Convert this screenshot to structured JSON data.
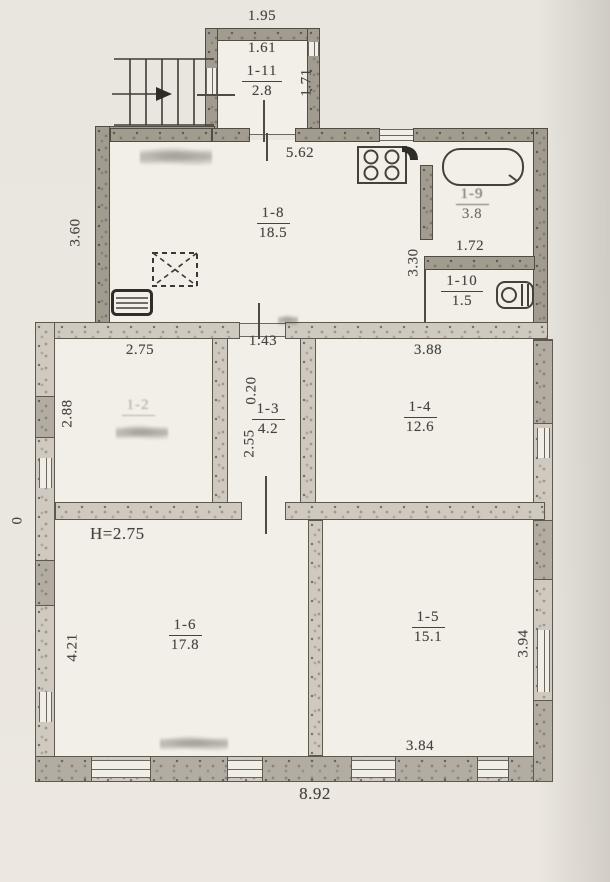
{
  "plan": {
    "height_note": "H=2.75",
    "rooms": [
      {
        "id": "1-11",
        "area": "2.8"
      },
      {
        "id": "1-8",
        "area": "18.5"
      },
      {
        "id": "1-9",
        "area": "3.8"
      },
      {
        "id": "1-10",
        "area": "1.5"
      },
      {
        "id": "1-2",
        "area": ""
      },
      {
        "id": "1-3",
        "area": "4.2"
      },
      {
        "id": "1-4",
        "area": "12.6"
      },
      {
        "id": "1-6",
        "area": "17.8"
      },
      {
        "id": "1-5",
        "area": "15.1"
      }
    ],
    "dims": {
      "d195": "1.95",
      "d161": "1.61",
      "d171": "1.71",
      "d562": "5.62",
      "d360": "3.60",
      "d330": "3.30",
      "d172": "1.72",
      "d275": "2.75",
      "d288": "2.88",
      "d143": "1.43",
      "d020": "0.20",
      "d255": "2.55",
      "d388": "3.88",
      "d0": "0",
      "d421": "4.21",
      "d394": "3.94",
      "d384": "3.84",
      "d892": "8.92"
    },
    "icons": {
      "stairs": "staircase with entry arrow",
      "stove": "4-burner stove",
      "bathtub": "bathtub",
      "toilet": "toilet",
      "radiator": "radiator",
      "hatch": "dashed floor hatch"
    }
  }
}
